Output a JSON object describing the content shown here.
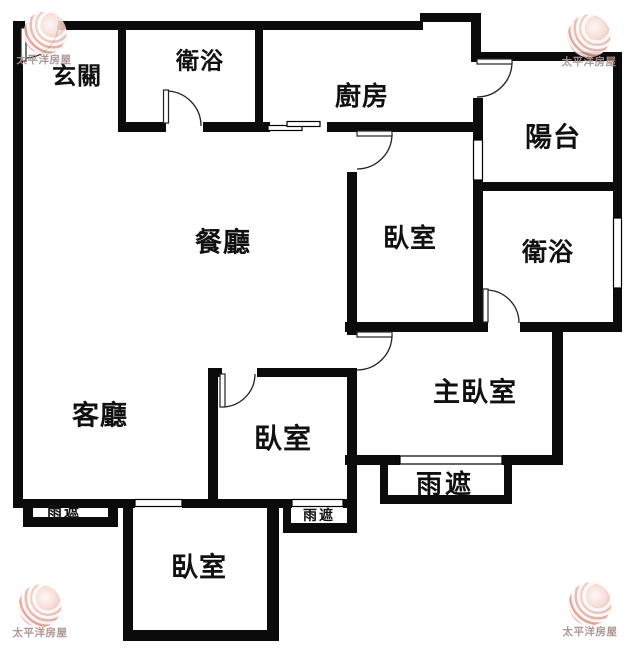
{
  "brand": {
    "name": "太平洋房屋"
  },
  "rooms": [
    {
      "id": "entry",
      "label": "玄關"
    },
    {
      "id": "bathroom-1",
      "label": "衛浴"
    },
    {
      "id": "kitchen",
      "label": "廚房"
    },
    {
      "id": "balcony",
      "label": "陽台"
    },
    {
      "id": "dining-room",
      "label": "餐廳"
    },
    {
      "id": "bedroom-1",
      "label": "臥室"
    },
    {
      "id": "bathroom-2",
      "label": "衛浴"
    },
    {
      "id": "living-room",
      "label": "客廳"
    },
    {
      "id": "master-bedroom",
      "label": "主臥室"
    },
    {
      "id": "bedroom-2",
      "label": "臥室"
    },
    {
      "id": "bedroom-3",
      "label": "臥室"
    },
    {
      "id": "rain-canopy-1",
      "label": "雨遮"
    },
    {
      "id": "rain-canopy-2",
      "label": "雨遮"
    },
    {
      "id": "rain-canopy-3",
      "label": "雨遮"
    }
  ],
  "colors": {
    "wall": "#0b0b0b",
    "background": "#ffffff",
    "logo_sphere": "#e2a299",
    "logo_text": "#ab9191"
  }
}
